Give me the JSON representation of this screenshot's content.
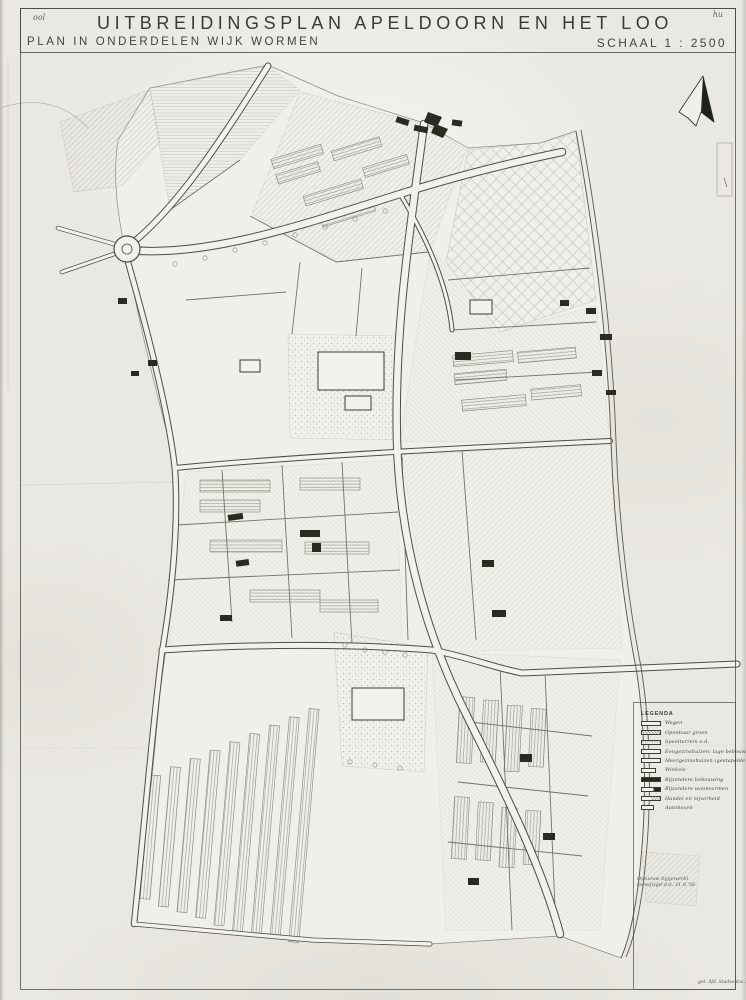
{
  "colors": {
    "paper": "#eae8e2",
    "ink": "#3e3e38",
    "building": "#2a2a22"
  },
  "header": {
    "corner_note_left": "ool",
    "corner_note_right": "hu",
    "title": "UITBREIDINGSPLAN APELDOORN EN HET LOO",
    "subtitle": "PLAN IN ONDERDELEN WIJK WORMEN",
    "scale_label": "SCHAAL 1 : 2500"
  },
  "legend": {
    "title": "LEGENDA",
    "items": [
      {
        "label": "Wegen",
        "swatch": "plain"
      },
      {
        "label": "Openbaar groen",
        "swatch": "hatch"
      },
      {
        "label": "Speelterrein e.d.",
        "swatch": "dots"
      },
      {
        "label": "Eengezinshuizen: lage bebouwing",
        "swatch": "plain"
      },
      {
        "label": "Meergezinshuizen (gestapelde bebouwing)",
        "swatch": "plain"
      },
      {
        "label": "Winkels",
        "swatch": "narrow"
      },
      {
        "label": "Bijzondere bebouwing",
        "swatch": "solid"
      },
      {
        "label": "Bijzondere woonvormen",
        "swatch": "half"
      },
      {
        "label": "Handel en nijverheid",
        "swatch": "diag"
      },
      {
        "label": "Autoboxen",
        "swatch": "small"
      }
    ]
  },
  "annotations": {
    "revision_line1": "Opnieuw bijgewerkt",
    "revision_line2": "Gewijzigd d.d. 31.8.'56",
    "signature": "get. Afd. Stadsontw. 2-1"
  }
}
